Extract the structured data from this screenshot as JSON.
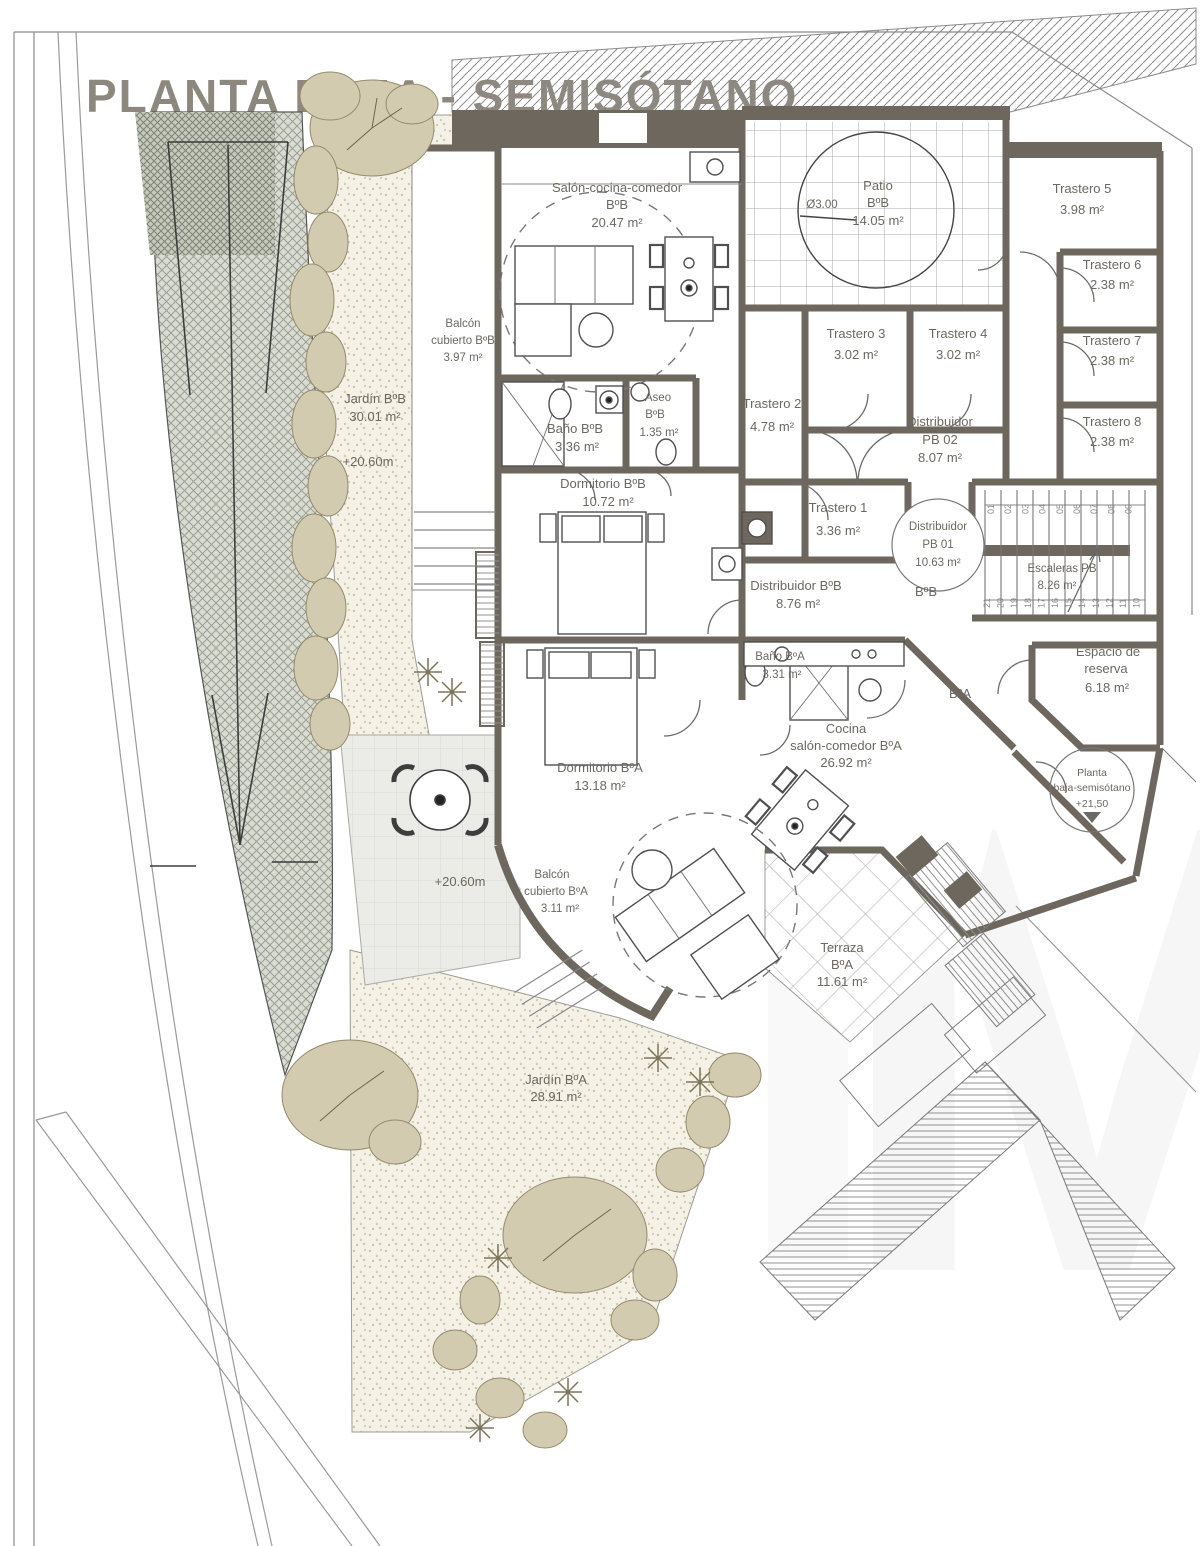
{
  "title": "PLANTA BAJA - SEMISÓTANO",
  "watermark": "M",
  "units": {
    "bb": "BºB",
    "ba": "BºA"
  },
  "levels": {
    "garden_bb": "+20.60m",
    "terrace": "+20.60m",
    "entry_l1": "Planta",
    "entry_l2": "baja-semisótano",
    "entry_level": "+21,50"
  },
  "rooms": {
    "salon_bb": {
      "name": "Salón-cocina-comedor",
      "unit": "BºB",
      "area": "20.47 m²"
    },
    "patio_bb": {
      "name": "Patio",
      "unit": "BºB",
      "area": "14.05 m²",
      "diameter": "Ø3.00"
    },
    "balcon_bb": {
      "l1": "Balcón",
      "l2": "cubierto BºB",
      "area": "3.97 m²"
    },
    "jardin_bb": {
      "name": "Jardín BºB",
      "area": "30.01 m²"
    },
    "trastero1": {
      "name": "Trastero 1",
      "area": "3.36 m²"
    },
    "trastero2": {
      "name": "Trastero 2",
      "area": "4.78 m²"
    },
    "trastero3": {
      "name": "Trastero 3",
      "area": "3.02 m²"
    },
    "trastero4": {
      "name": "Trastero 4",
      "area": "3.02 m²"
    },
    "trastero5": {
      "name": "Trastero 5",
      "area": "3.98 m²"
    },
    "trastero6": {
      "name": "Trastero 6",
      "area": "2.38 m²"
    },
    "trastero7": {
      "name": "Trastero 7",
      "area": "2.38 m²"
    },
    "trastero8": {
      "name": "Trastero 8",
      "area": "2.38 m²"
    },
    "dist_pb02": {
      "name": "Distribuidor",
      "code": "PB 02",
      "area": "8.07 m²"
    },
    "dist_pb01": {
      "name": "Distribuidor",
      "code": "PB 01",
      "area": "10.63 m²"
    },
    "escaleras": {
      "name": "Escaleras PB",
      "area": "8.26 m²"
    },
    "bano_bb": {
      "name": "Baño BºB",
      "area": "3.36 m²"
    },
    "aseo_bb": {
      "l1": "Aseo",
      "l2": "BºB",
      "area": "1.35 m²"
    },
    "dorm_bb": {
      "name": "Dormitorio BºB",
      "area": "10.72 m²"
    },
    "dist_bb": {
      "name": "Distribuidor BºB",
      "area": "8.76 m²"
    },
    "bano_ba": {
      "name": "Baño BºA",
      "area": "3.31 m²"
    },
    "dorm_ba": {
      "name": "Dormitorio BºA",
      "area": "13.18 m²"
    },
    "cocina_ba": {
      "l1": "Cocina",
      "l2": "salón-comedor BºA",
      "area": "26.92 m²"
    },
    "balcon_ba": {
      "l1": "Balcón",
      "l2": "cubierto BºA",
      "area": "3.11 m²"
    },
    "terraza_ba": {
      "name": "Terraza",
      "unit": "BºA",
      "area": "11.61 m²"
    },
    "jardin_ba": {
      "name": "Jardín BºA",
      "area": "28.91 m²"
    },
    "espacio": {
      "l1": "Espacio de",
      "l2": "reserva",
      "area": "6.18 m²"
    }
  },
  "stairs": {
    "steps_top": [
      "01",
      "02",
      "03",
      "04",
      "05",
      "06",
      "07",
      "08",
      "09"
    ],
    "steps_bottom": [
      "21",
      "20",
      "19",
      "18",
      "17",
      "16",
      "15",
      "14",
      "13",
      "12",
      "11",
      "10"
    ]
  }
}
